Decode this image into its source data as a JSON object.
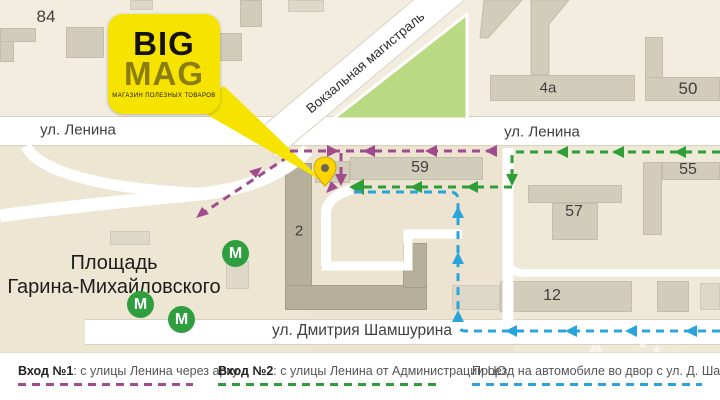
{
  "logo": {
    "line1": "BIG",
    "line2": "MAG",
    "tagline": "МАГАЗИН ПОЛЕЗНЫХ ТОВАРОВ"
  },
  "streets": {
    "lenina_left": "ул. Ленина",
    "lenina_right": "ул. Ленина",
    "vokzalnaya": "Вокзальная магистраль",
    "shamshurina": "ул. Дмитрия Шамшурина"
  },
  "square": {
    "line1": "Площадь",
    "line2": "Гарина-Михайловского"
  },
  "buildings": {
    "b84": "84",
    "b4a": "4а",
    "b50": "50",
    "b59": "59",
    "b55": "55",
    "b57": "57",
    "b2": "2",
    "b12": "12"
  },
  "metro": {
    "letter": "М"
  },
  "legend": {
    "items": [
      {
        "bold": "Вход №1",
        "text": ": с улицы Ленина через арку",
        "color": "#a14b8f"
      },
      {
        "bold": "Вход №2",
        "text": ": с улицы Ленина от Администрации ЦО",
        "color": "#2f9e38"
      },
      {
        "bold": "",
        "text": "Проезд на автомобиле во двор с ул. Д. Шамшурина",
        "color": "#29a5dc"
      }
    ]
  },
  "watermark": "Avito",
  "colors": {
    "e1": "#a14b8f",
    "e2": "#2f9e38",
    "car": "#29a5dc",
    "park": "#b9da82",
    "metro": "#2f9e3f",
    "logo": "#f6e300"
  }
}
